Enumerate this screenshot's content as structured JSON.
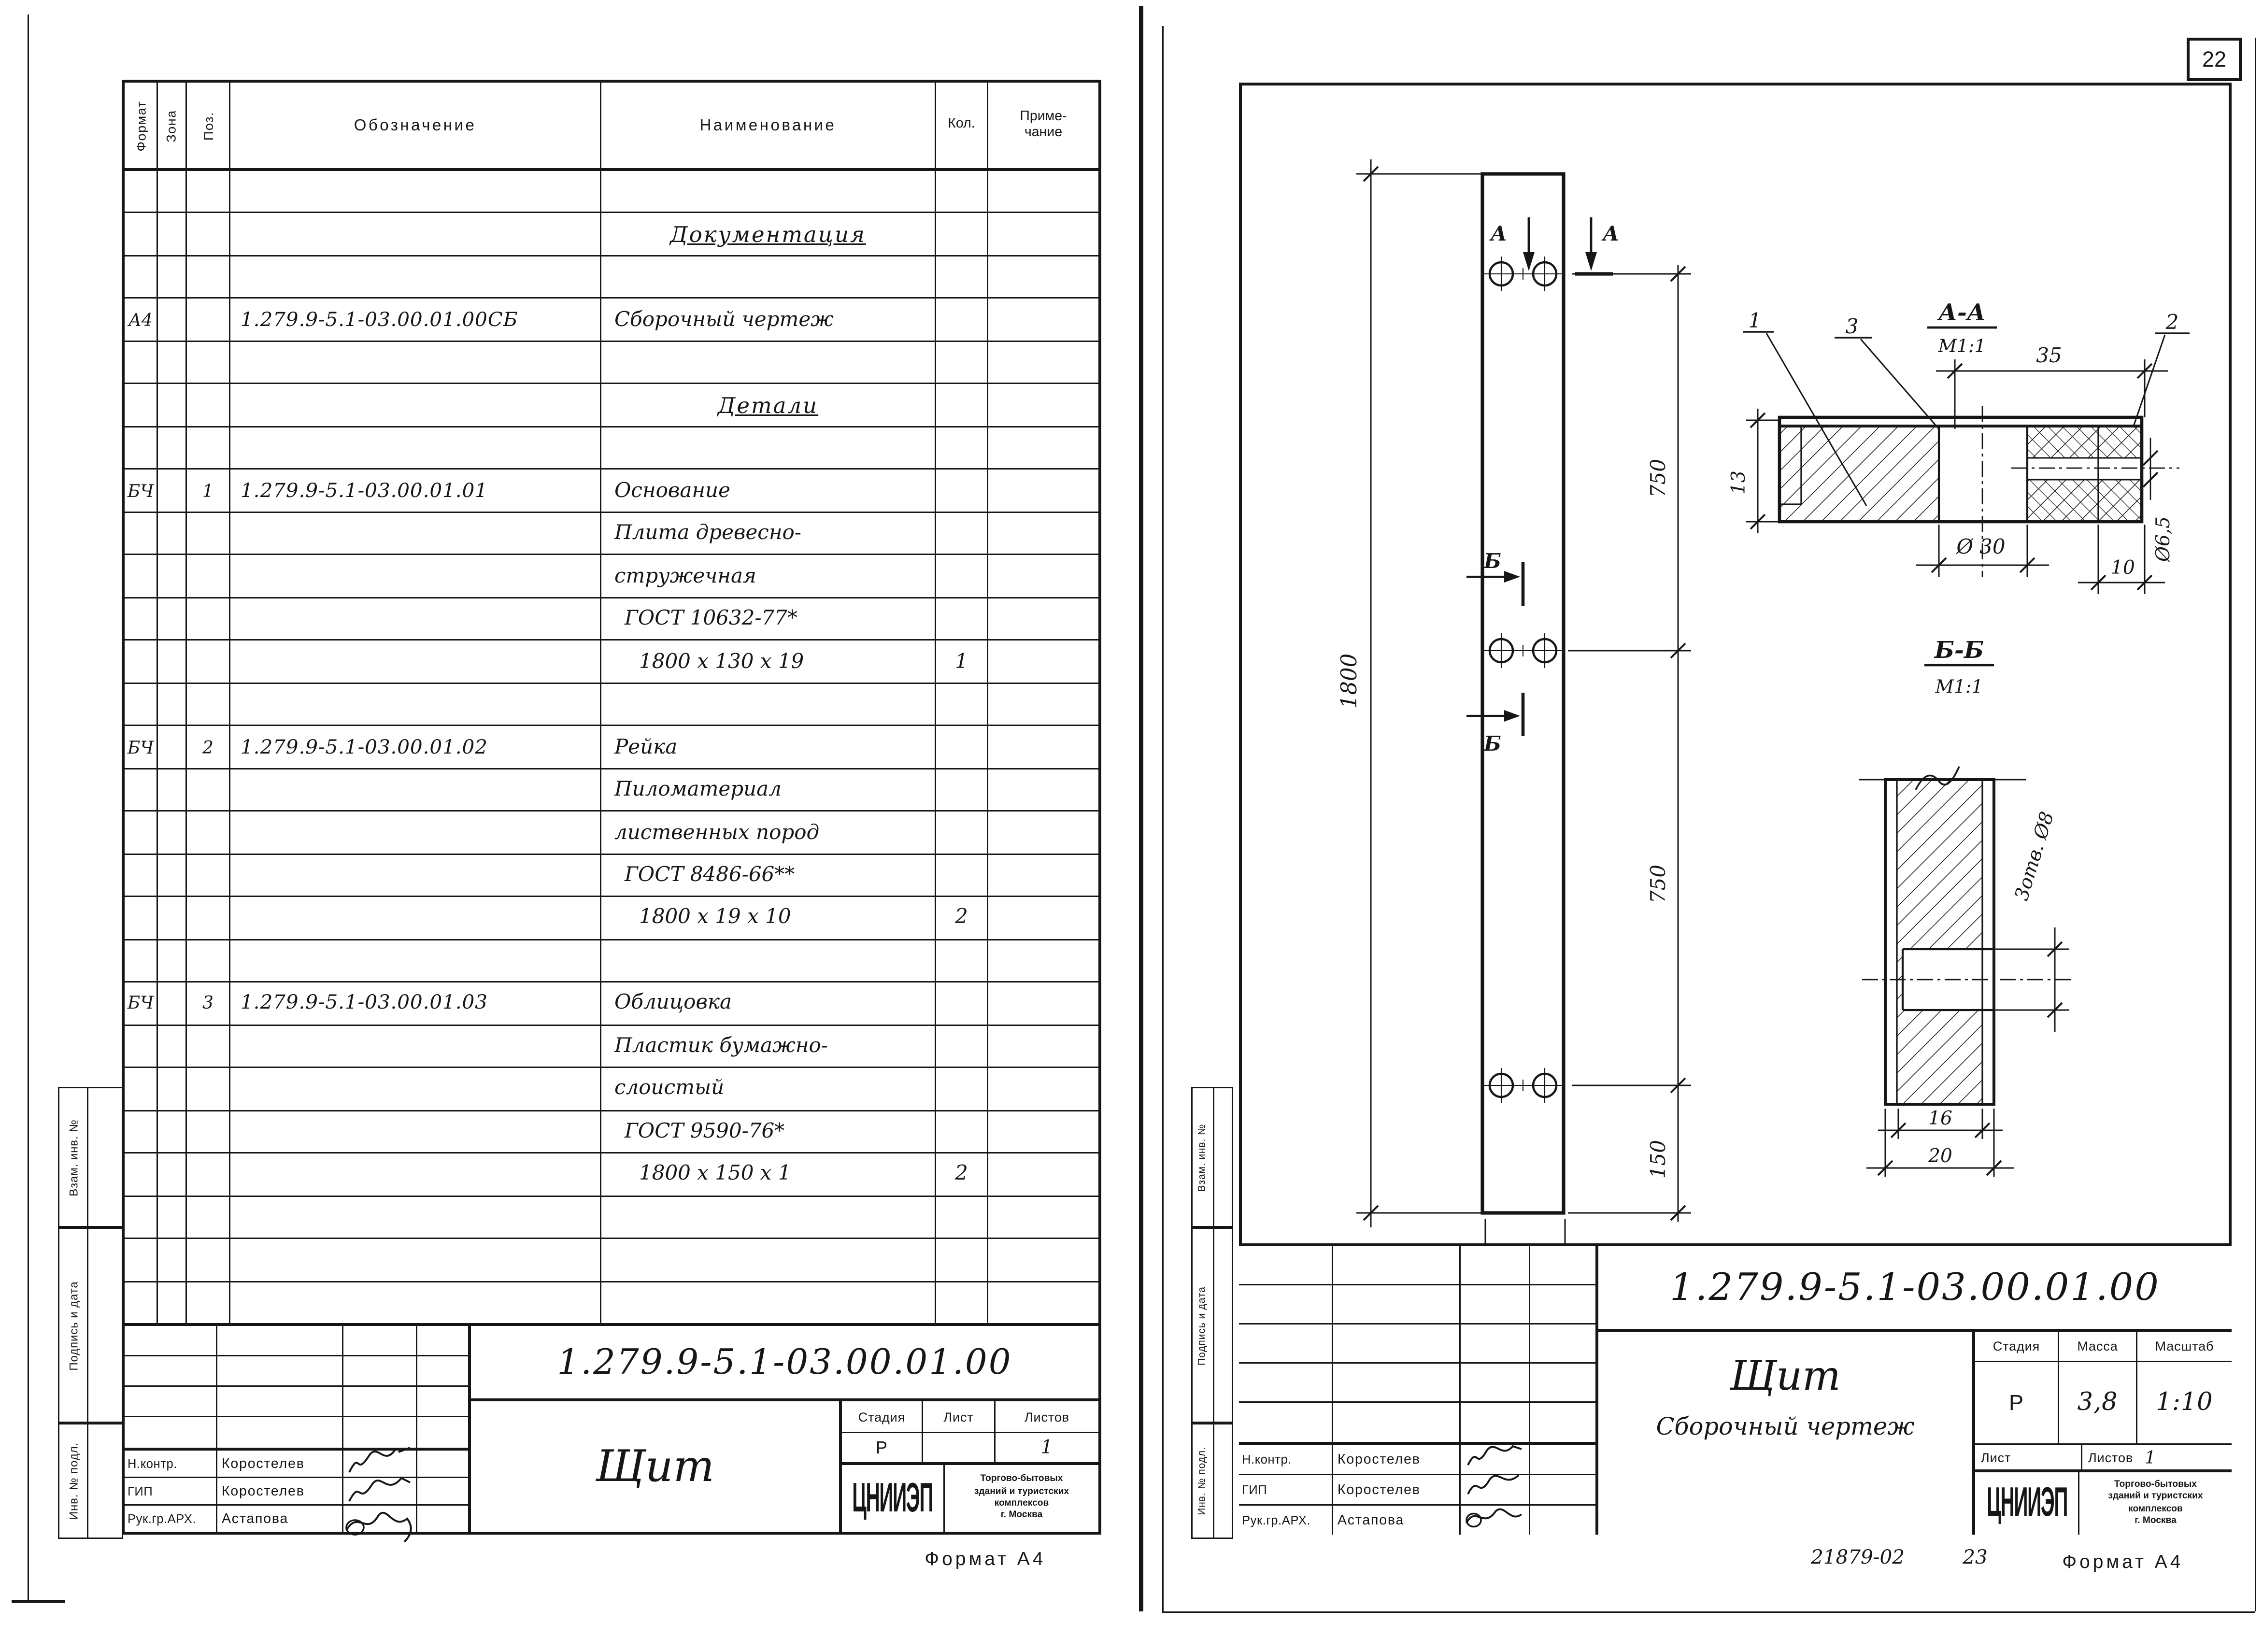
{
  "page_number": "22",
  "footer_right": {
    "doc_no": "21879-02",
    "sheet_no": "23",
    "format_note": "Формат А4"
  },
  "footer_left": {
    "format_note": "Формат А4"
  },
  "side_stamps": {
    "top": "Взам. инв. №",
    "middle": "Подпись и дата",
    "bottom": "Инв. № подл."
  },
  "left_sheet": {
    "spec_table": {
      "headers": {
        "format": "Формат",
        "zone": "Зона",
        "pos": "Поз.",
        "designation": "Обозначение",
        "name": "Наименование",
        "qty": "Кол.",
        "note1": "Приме-",
        "note2": "чание"
      },
      "rows": [
        {},
        {
          "name": "Документация",
          "u": true
        },
        {},
        {
          "fmt": "А4",
          "des": "1.279.9-5.1-03.00.01.00СБ",
          "name": "Сборочный чертеж"
        },
        {},
        {
          "name": "Детали",
          "u": true
        },
        {},
        {
          "fmt": "БЧ",
          "pos": "1",
          "des": "1.279.9-5.1-03.00.01.01",
          "name": "Основание"
        },
        {
          "name": "Плита древесно-"
        },
        {
          "name": "стружечная"
        },
        {
          "name": "ГОСТ 10632-77*",
          "ind": 1
        },
        {
          "name": "1800 x 130 x 19",
          "qty": "1",
          "ind": 2
        },
        {},
        {
          "fmt": "БЧ",
          "pos": "2",
          "des": "1.279.9-5.1-03.00.01.02",
          "name": "Рейка"
        },
        {
          "name": "Пиломатериал"
        },
        {
          "name": "лиственных пород"
        },
        {
          "name": "ГОСТ 8486-66**",
          "ind": 1
        },
        {
          "name": "1800 x 19 x 10",
          "qty": "2",
          "ind": 2
        },
        {},
        {
          "fmt": "БЧ",
          "pos": "3",
          "des": "1.279.9-5.1-03.00.01.03",
          "name": "Облицовка"
        },
        {
          "name": "Пластик бумажно-"
        },
        {
          "name": "слоистый"
        },
        {
          "name": "ГОСТ 9590-76*",
          "ind": 1
        },
        {
          "name": "1800 x 150 x 1",
          "qty": "2",
          "ind": 2
        },
        {},
        {},
        {}
      ]
    },
    "title_block": {
      "designation": "1.279.9-5.1-03.00.01.00",
      "name": "Щит",
      "stage_label": "Стадия",
      "sheet_label": "Лист",
      "sheets_label": "Листов",
      "stage": "Р",
      "sheet": "",
      "sheets": "1",
      "org_logo": "ЦНИИЭП",
      "org_line1": "Торгово-бытовых",
      "org_line2": "зданий и туристских",
      "org_line3": "комплексов",
      "org_line4": "г. Москва",
      "roles": [
        {
          "role": "Н.контр.",
          "name": "Коростелев"
        },
        {
          "role": "ГИП",
          "name": "Коростелев"
        },
        {
          "role": "Рук.гр.АРХ.",
          "name": "Астапова"
        }
      ]
    }
  },
  "right_sheet": {
    "title_block": {
      "designation": "1.279.9-5.1-03.00.01.00",
      "name": "Щит",
      "subtitle": "Сборочный чертеж",
      "stage_label": "Стадия",
      "mass_label": "Масса",
      "scale_label": "Масштаб",
      "stage": "Р",
      "mass": "3,8",
      "scale": "1:10",
      "sheet_label": "Лист",
      "sheets_label": "Листов",
      "sheets": "1",
      "org_logo": "ЦНИИЭП",
      "org_line1": "Торгово-бытовых",
      "org_line2": "зданий и туристских",
      "org_line3": "комплексов",
      "org_line4": "г. Москва",
      "roles": [
        {
          "role": "Н.контр.",
          "name": "Коростелев"
        },
        {
          "role": "ГИП",
          "name": "Коростелев"
        },
        {
          "role": "Рук.гр.АРХ.",
          "name": "Астапова"
        }
      ]
    },
    "drawing": {
      "front_view": {
        "height_dim": "1800",
        "seg_top": "750",
        "seg_mid": "750",
        "seg_bottom": "150",
        "width_dim": "150",
        "section_a": "А",
        "section_b": "Б"
      },
      "section_aa": {
        "title": "А-А",
        "scale": "М1:1",
        "leader_1": "1",
        "leader_3": "3",
        "leader_2": "2",
        "dim_width": "35",
        "dim_thickness": "13",
        "dim_hole": "Ø 30",
        "dim_edge": "10",
        "dim_small_hole": "Ø6,5"
      },
      "section_bb": {
        "title": "Б-Б",
        "scale": "М1:1",
        "dim_inner": "16",
        "dim_outer": "20",
        "holes_note": "3отв. Ø8"
      }
    }
  }
}
